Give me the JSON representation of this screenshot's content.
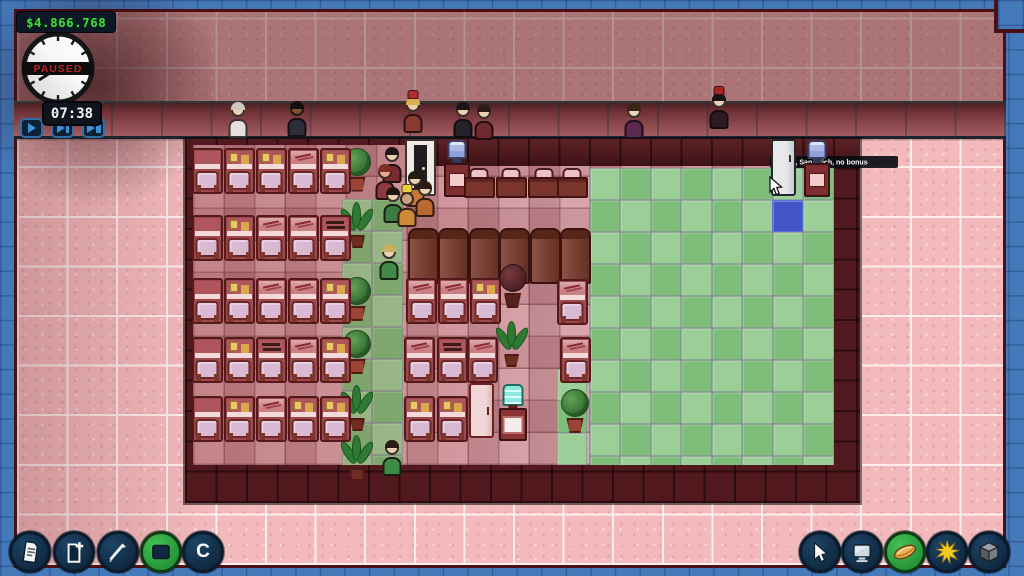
{
  "hud": {
    "money": "$4.866.768",
    "clock": {
      "paused_label": "PAUSED",
      "time": "07:38"
    },
    "speed_buttons": [
      {
        "name": "speed-play",
        "glyph": "play"
      },
      {
        "name": "speed-fast",
        "glyph": "fast"
      },
      {
        "name": "speed-fastest",
        "glyph": "fastest"
      }
    ]
  },
  "tooltip": {
    "text": "Fridge, Sandwich, no bonus"
  },
  "toolbar_left": {
    "items": [
      {
        "name": "reports",
        "icon": "document",
        "variant": "navy"
      },
      {
        "name": "new-document",
        "icon": "document-add",
        "variant": "navy"
      },
      {
        "name": "draw-tool",
        "icon": "pen",
        "variant": "navy"
      },
      {
        "name": "room-tool",
        "icon": "room",
        "variant": "green"
      },
      {
        "name": "center-view",
        "icon": "letter",
        "variant": "navy",
        "label": "C"
      }
    ]
  },
  "toolbar_right": {
    "items": [
      {
        "name": "select-tool",
        "icon": "cursor",
        "variant": "navy"
      },
      {
        "name": "computers",
        "icon": "monitor",
        "variant": "navy"
      },
      {
        "name": "food",
        "icon": "hotdog",
        "variant": "green"
      },
      {
        "name": "daylight",
        "icon": "sun",
        "variant": "navy"
      },
      {
        "name": "objects-3d",
        "icon": "cube",
        "variant": "navy"
      }
    ]
  },
  "colors": {
    "money_green": "#3ae03a",
    "paused_red": "#bf2222",
    "background_blue": "#4479ba",
    "brick_pink": "#f2babc",
    "wall_maroon": "#51191d",
    "zone_green_light": "#9ccf97",
    "zone_green_dark": "#7ebd7a",
    "selected_tile_blue": "#4356c8",
    "toolbar_navy": "#122d47",
    "toolbar_green": "#2a9a3c"
  },
  "map": {
    "metrics": {
      "tw": 30.5,
      "th": 32,
      "ox": 192.5,
      "oy": 145,
      "fx": 192.5,
      "fy": 145
    },
    "green_zones": [
      {
        "c": 13.02,
        "r": 0.72,
        "cols": 8,
        "rows": 10
      },
      {
        "c": 4.9,
        "r": 1.7,
        "cols": 2,
        "rows": 9
      },
      {
        "c": 11.95,
        "r": 7.0,
        "cols": 1,
        "rows": 3
      }
    ],
    "special_tiles": [
      {
        "type": "blue",
        "c": 19.0,
        "r": 1.71
      }
    ],
    "objects": [
      {
        "type": "desk-s",
        "c": -0.02,
        "r": 0.1,
        "deco": "plain"
      },
      {
        "type": "desk-s",
        "c": 1.03,
        "r": 0.1,
        "deco": "notes"
      },
      {
        "type": "desk-s",
        "c": 2.08,
        "r": 0.1,
        "deco": "notes"
      },
      {
        "type": "desk-s",
        "c": 3.13,
        "r": 0.1,
        "deco": "sketch"
      },
      {
        "type": "desk-s",
        "c": 4.18,
        "r": 0.1,
        "deco": "notes"
      },
      {
        "type": "desk-s",
        "c": -0.02,
        "r": 2.2,
        "deco": "plain"
      },
      {
        "type": "desk-s",
        "c": 1.03,
        "r": 2.2,
        "deco": "notes"
      },
      {
        "type": "desk-s",
        "c": 2.08,
        "r": 2.2,
        "deco": "sketch"
      },
      {
        "type": "desk-s",
        "c": 3.13,
        "r": 2.2,
        "deco": "sketch"
      },
      {
        "type": "desk-s",
        "c": 4.18,
        "r": 2.2,
        "deco": "dark"
      },
      {
        "type": "desk-s",
        "c": -0.02,
        "r": 4.15,
        "deco": "plain"
      },
      {
        "type": "desk-s",
        "c": 1.03,
        "r": 4.15,
        "deco": "notes"
      },
      {
        "type": "desk-s",
        "c": 2.08,
        "r": 4.15,
        "deco": "sketch"
      },
      {
        "type": "desk-s",
        "c": 3.13,
        "r": 4.15,
        "deco": "sketch"
      },
      {
        "type": "desk-s",
        "c": 4.18,
        "r": 4.15,
        "deco": "notes"
      },
      {
        "type": "desk-s",
        "c": -0.02,
        "r": 6.0,
        "deco": "plain"
      },
      {
        "type": "desk-s",
        "c": 1.03,
        "r": 6.0,
        "deco": "notes"
      },
      {
        "type": "desk-s",
        "c": 2.08,
        "r": 6.0,
        "deco": "dark"
      },
      {
        "type": "desk-s",
        "c": 3.13,
        "r": 6.0,
        "deco": "sketch"
      },
      {
        "type": "desk-s",
        "c": 4.18,
        "r": 6.0,
        "deco": "notes"
      },
      {
        "type": "desk-s",
        "c": -0.02,
        "r": 7.85,
        "deco": "plain"
      },
      {
        "type": "desk-s",
        "c": 1.03,
        "r": 7.85,
        "deco": "notes"
      },
      {
        "type": "desk-s",
        "c": 2.08,
        "r": 7.85,
        "deco": "sketch"
      },
      {
        "type": "desk-s",
        "c": 3.13,
        "r": 7.85,
        "deco": "notes"
      },
      {
        "type": "desk-s",
        "c": 4.18,
        "r": 7.85,
        "deco": "notes"
      },
      {
        "type": "desk-n",
        "c": 8.9,
        "r": 0.72
      },
      {
        "type": "desk-n",
        "c": 9.95,
        "r": 0.72
      },
      {
        "type": "desk-n",
        "c": 11.0,
        "r": 0.72
      },
      {
        "type": "desk-n",
        "c": 11.95,
        "r": 0.72
      },
      {
        "type": "cabinet",
        "c": 7.05,
        "r": 2.58
      },
      {
        "type": "cabinet",
        "c": 8.05,
        "r": 2.58
      },
      {
        "type": "cabinet",
        "c": 9.05,
        "r": 2.58
      },
      {
        "type": "cabinet",
        "c": 10.05,
        "r": 2.58
      },
      {
        "type": "cabinet",
        "c": 11.05,
        "r": 2.58
      },
      {
        "type": "cabinet",
        "c": 12.05,
        "r": 2.58
      },
      {
        "type": "desk-s",
        "c": 7.0,
        "r": 4.15,
        "deco": "sketch"
      },
      {
        "type": "desk-s",
        "c": 8.05,
        "r": 4.15,
        "deco": "sketch"
      },
      {
        "type": "desk-s",
        "c": 9.1,
        "r": 4.15,
        "deco": "notes"
      },
      {
        "type": "desk-s",
        "c": 11.95,
        "r": 4.18,
        "deco": "sketch"
      },
      {
        "type": "desk-s",
        "c": 6.95,
        "r": 6.0,
        "deco": "sketch"
      },
      {
        "type": "desk-s",
        "c": 8.0,
        "r": 6.0,
        "deco": "dark"
      },
      {
        "type": "desk-s",
        "c": 9.0,
        "r": 6.0,
        "deco": "sketch"
      },
      {
        "type": "desk-s",
        "c": 12.05,
        "r": 6.0,
        "deco": "sketch"
      },
      {
        "type": "desk-s",
        "c": 6.95,
        "r": 7.85,
        "deco": "notes"
      },
      {
        "type": "desk-s",
        "c": 8.0,
        "r": 7.85,
        "deco": "notes"
      },
      {
        "type": "plant-bush",
        "c": 4.95,
        "r": 0.08
      },
      {
        "type": "plant-yucca",
        "c": 4.95,
        "r": 1.78
      },
      {
        "type": "plant-bush",
        "c": 4.95,
        "r": 4.12
      },
      {
        "type": "plant-bush",
        "c": 4.95,
        "r": 5.78
      },
      {
        "type": "plant-yucca",
        "c": 4.95,
        "r": 7.5
      },
      {
        "type": "plant-yucca",
        "c": 4.95,
        "r": 9.05
      },
      {
        "type": "plant-dark",
        "c": 10.05,
        "r": 3.72
      },
      {
        "type": "plant-yucca",
        "c": 10.0,
        "r": 5.5
      },
      {
        "type": "plant-bush",
        "c": 12.1,
        "r": 7.62
      },
      {
        "type": "door-entr",
        "c": 6.98,
        "r": -0.18
      },
      {
        "type": "cooler-station",
        "c": 8.18,
        "r": -0.15
      },
      {
        "type": "fridge-gray",
        "c": 18.98,
        "r": -0.2
      },
      {
        "type": "cooler-station",
        "c": 19.98,
        "r": -0.15
      },
      {
        "type": "fridge-pink",
        "c": 9.08,
        "r": 7.45
      },
      {
        "type": "cooler-cyan",
        "c": 10.02,
        "r": 7.48
      },
      {
        "type": "cursor-spr",
        "c": 18.87,
        "r": 0.97
      }
    ],
    "people": [
      {
        "x": 238,
        "y": 98,
        "body": "#e6dfdb",
        "head": "#ecd2b4",
        "hair": "#cfc6c0",
        "area": "street"
      },
      {
        "x": 297,
        "y": 97,
        "body": "#2b2d3b",
        "head": "#7c5237",
        "hair": "#15100e",
        "area": "street"
      },
      {
        "x": 413,
        "y": 93,
        "body": "#8a3a30",
        "head": "#eccfa8",
        "hair": "#d8b050",
        "hat": "#b22d2d",
        "area": "street"
      },
      {
        "x": 463,
        "y": 98,
        "body": "#26222c",
        "head": "#ecd2b4",
        "hair": "#181418",
        "area": "street"
      },
      {
        "x": 484,
        "y": 100,
        "body": "#6e2830",
        "head": "#ecd2b4",
        "hair": "#2a1c14",
        "area": "street"
      },
      {
        "x": 634,
        "y": 99,
        "body": "#5c2a4e",
        "head": "#ecd2b4",
        "hair": "#3a2416",
        "area": "street"
      },
      {
        "x": 719,
        "y": 89,
        "body": "#2e1a22",
        "head": "#ecd2b4",
        "hair": "#1a1212",
        "hat": "#a82424",
        "area": "street"
      },
      {
        "x": 392,
        "y": 143,
        "body": "#7a2a34",
        "head": "#ecd2b4",
        "hair": "#201418",
        "area": "office"
      },
      {
        "x": 385,
        "y": 160,
        "body": "#8a3a40",
        "head": "#eaa88e",
        "hair": "#7a3028",
        "area": "office"
      },
      {
        "x": 415,
        "y": 167,
        "body": "#c87838",
        "head": "#ecd2b4",
        "hair": "#241a14",
        "area": "office"
      },
      {
        "x": 393,
        "y": 183,
        "body": "#3f7a40",
        "head": "#ecd2b4",
        "hair": "#1e1410",
        "area": "office"
      },
      {
        "x": 407,
        "y": 187,
        "body": "#cf8838",
        "head": "#c9a37c",
        "hat": "#e8cf40",
        "area": "office"
      },
      {
        "x": 425,
        "y": 177,
        "body": "#b86a30",
        "head": "#ecd2b4",
        "hair": "#2a1a12",
        "area": "office"
      },
      {
        "x": 389,
        "y": 240,
        "body": "#3f8a46",
        "head": "#ecd2b4",
        "hair": "#c8b060",
        "area": "office"
      },
      {
        "x": 392,
        "y": 436,
        "body": "#3f8a46",
        "head": "#ecd2b4",
        "hair": "#2a1c12",
        "area": "office"
      }
    ]
  }
}
